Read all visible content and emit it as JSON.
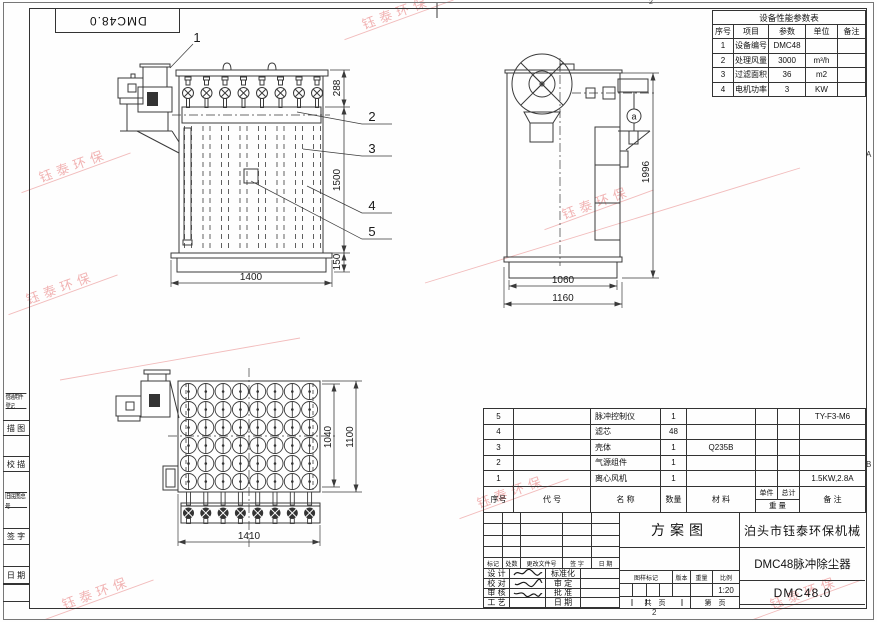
{
  "drawing": {
    "stamp": "DMC48.0",
    "watermark": "钰泰环保",
    "zones": {
      "top": "2",
      "bottom": "2",
      "right_upper": "A",
      "right_lower": "B"
    },
    "margin_labels": [
      "借通用件登记",
      "描 图",
      "校 描",
      "旧底图总号",
      "签 字",
      "日 期"
    ]
  },
  "equipment_table": {
    "title": "设备性能参数表",
    "headers": [
      "序号",
      "项目",
      "参数",
      "单位",
      "备注"
    ],
    "rows": [
      [
        "1",
        "设备编号",
        "DMC48",
        "",
        ""
      ],
      [
        "2",
        "处理风量",
        "3000",
        "m³/h",
        ""
      ],
      [
        "3",
        "过滤面积",
        "36",
        "m2",
        ""
      ],
      [
        "4",
        "电机功率",
        "3",
        "KW",
        ""
      ]
    ]
  },
  "bom": {
    "headers": {
      "no": "序号",
      "code": "代  号",
      "name": "名  称",
      "qty": "数量",
      "material": "材  料",
      "unit": "单件",
      "total": "总计",
      "weight": "重 量",
      "remark": "备  注"
    },
    "rows": [
      {
        "no": "5",
        "code": "",
        "name": "脉冲控制仪",
        "qty": "1",
        "material": "",
        "unit": "",
        "total": "",
        "remark": "TY-F3-M6"
      },
      {
        "no": "4",
        "code": "",
        "name": "滤芯",
        "qty": "48",
        "material": "",
        "unit": "",
        "total": "",
        "remark": ""
      },
      {
        "no": "3",
        "code": "",
        "name": "壳体",
        "qty": "1",
        "material": "Q235B",
        "unit": "",
        "total": "",
        "remark": ""
      },
      {
        "no": "2",
        "code": "",
        "name": "气源组件",
        "qty": "1",
        "material": "",
        "unit": "",
        "total": "",
        "remark": ""
      },
      {
        "no": "1",
        "code": "",
        "name": "离心风机",
        "qty": "1",
        "material": "",
        "unit": "",
        "total": "",
        "remark": "1.5KW,2.8A"
      }
    ]
  },
  "title_block": {
    "revision_headers": [
      "标记",
      "处数",
      "更改文件号",
      "签 字",
      "日 期"
    ],
    "sign_rows": [
      {
        "left": "设 计",
        "right": "标准化"
      },
      {
        "left": "校 对",
        "right": "审 定"
      },
      {
        "left": "审 核",
        "right": "批 准"
      },
      {
        "left": "工 艺",
        "right": "日 期"
      }
    ],
    "doc_type": "方案图",
    "mark_headers": [
      "图样标记",
      "版本",
      "重量",
      "比例"
    ],
    "scale": "1:20",
    "sheet_total": "共　页",
    "sheet_no": "第　页",
    "company": "泊头市钰泰环保机械",
    "product": "DMC48脉冲除尘器",
    "model": "DMC48.0"
  },
  "views": {
    "front": {
      "dim_top": "288",
      "dim_body": "1500",
      "dim_base": "150",
      "dim_width": "1400",
      "callouts": [
        "1",
        "2",
        "3",
        "4",
        "5"
      ]
    },
    "side": {
      "dim_height": "1996",
      "dim_inner": "1060",
      "dim_outer": "1160",
      "detail": "a"
    },
    "top": {
      "dim_grid": "1040",
      "dim_depth": "1100",
      "dim_width": "1410"
    }
  }
}
